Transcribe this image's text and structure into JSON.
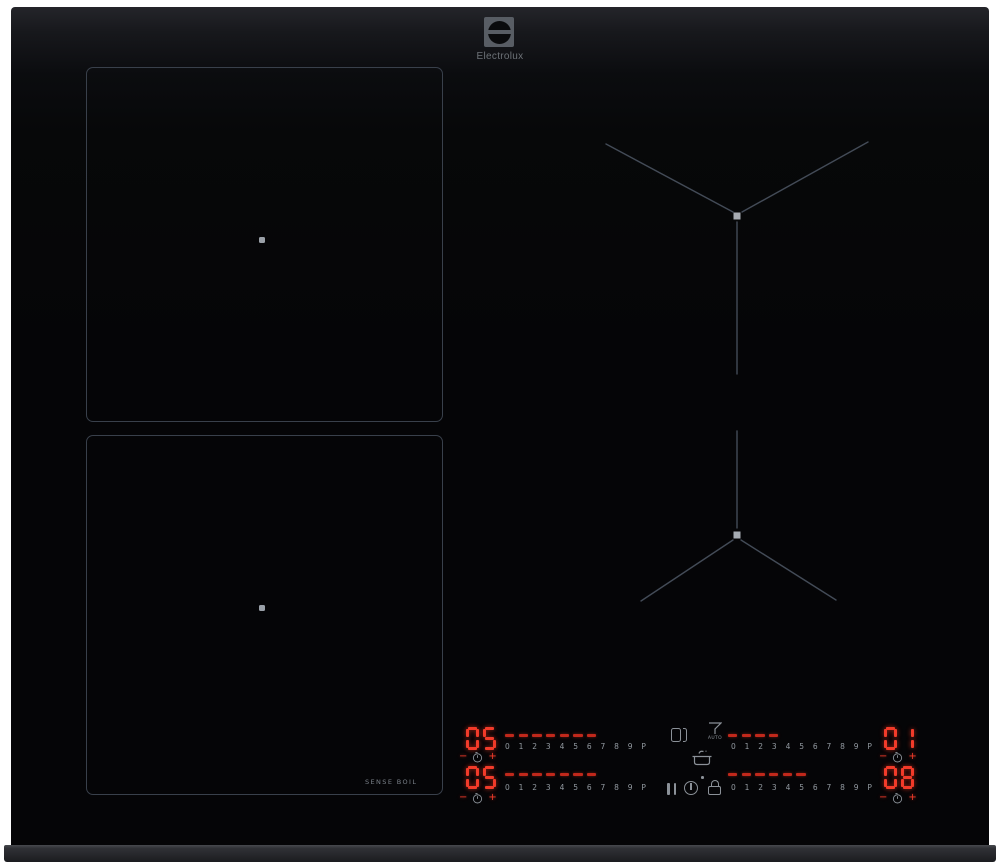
{
  "brand": {
    "name": "Electrolux"
  },
  "labels": {
    "sense_boil": "SENSE BOIL",
    "hood_auto": "AUTO"
  },
  "slider_scale": [
    "0",
    "1",
    "2",
    "3",
    "4",
    "5",
    "6",
    "7",
    "8",
    "9",
    "P"
  ],
  "controls": {
    "stepper": {
      "minus": "−",
      "plus": "+"
    },
    "left": {
      "rows": [
        {
          "display": "05",
          "dashes": 7
        },
        {
          "display": "05",
          "dashes": 7
        }
      ]
    },
    "right": {
      "rows": [
        {
          "display": "01",
          "dashes": 4
        },
        {
          "display": "08",
          "dashes": 6
        }
      ]
    }
  },
  "icons": {
    "bridge": "bridge-zones-icon",
    "hood": "hob2hood-auto-icon",
    "pot": "sense-boil-pot-icon",
    "pause": "pause-icon",
    "power": "power-icon",
    "lock": "child-lock-icon",
    "timer": "timer-clock-icon"
  },
  "colors": {
    "led_red": "#f23b2a",
    "dash_red": "#c1281b",
    "icon_gray": "#8b9198",
    "zone_line": "#39404b",
    "marker_line": "#434b57",
    "marker_dot": "#a6abb2"
  }
}
